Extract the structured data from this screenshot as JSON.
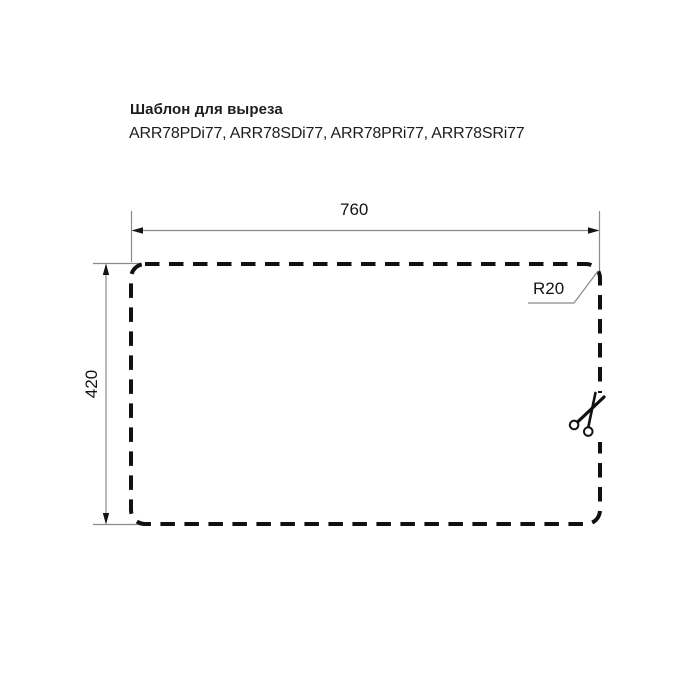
{
  "header": {
    "title": "Шаблон для выреза",
    "models": "ARR78PDi77, ARR78SDi77, ARR78PRi77, ARR78SRi77"
  },
  "drawing": {
    "width_label": "760",
    "height_label": "420",
    "radius_label": "R20",
    "cutout": {
      "width_mm": 760,
      "height_mm": 420,
      "corner_radius_mm": 20
    },
    "icons": {
      "scissors": "scissors-icon"
    },
    "colors": {
      "background": "#ffffff",
      "text": "#1d1d1d",
      "ink": "#141414",
      "outline": "#111111",
      "dimension_line": "#8a8a8a"
    }
  }
}
